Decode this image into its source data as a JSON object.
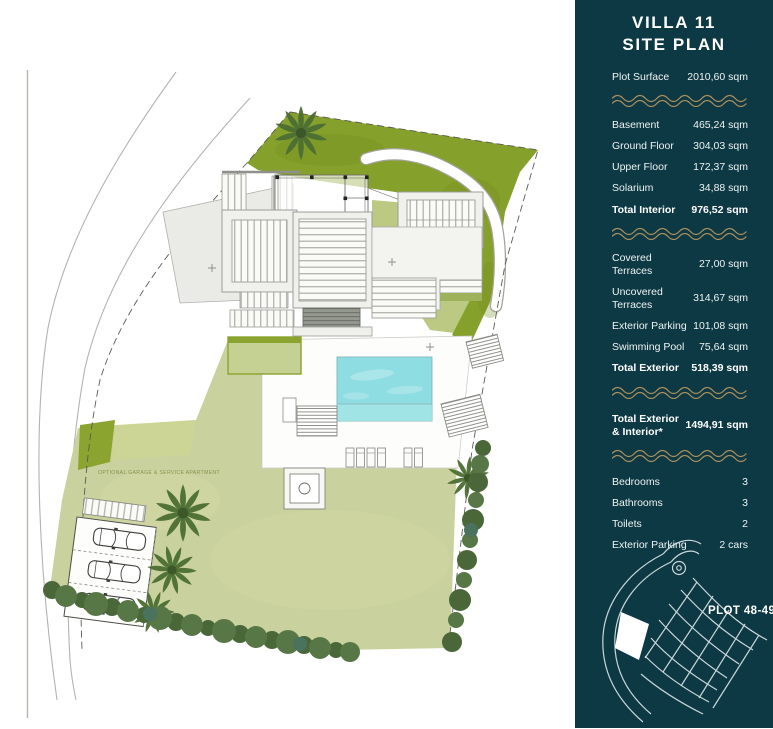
{
  "plan": {
    "note_label": "OPTIONAL GARAGE & SERVICE APARTMENT",
    "colors": {
      "band_green": "#86a02c",
      "light_green": "#bcc983",
      "lawn": "#c9d29e",
      "pool": "#8edde2",
      "concrete": "#f0f0ed",
      "road_line": "#b3b3af"
    }
  },
  "sidebar": {
    "background": "#0d3944",
    "wave_color": "#ab8f5c",
    "title_line1": "VILLA 11",
    "title_line2": "SITE PLAN",
    "plot_surface": {
      "label": "Plot Surface",
      "value": "2010,60 sqm"
    },
    "interior": {
      "rows": [
        {
          "label": "Basement",
          "value": "465,24 sqm"
        },
        {
          "label": "Ground Floor",
          "value": "304,03 sqm"
        },
        {
          "label": "Upper Floor",
          "value": "172,37 sqm"
        },
        {
          "label": "Solarium",
          "value": "34,88 sqm"
        }
      ],
      "total": {
        "label": "Total Interior",
        "value": "976,52 sqm"
      }
    },
    "exterior": {
      "rows": [
        {
          "label": "Covered Terraces",
          "value": "27,00 sqm"
        },
        {
          "label": "Uncovered Terraces",
          "value": "314,67 sqm"
        },
        {
          "label": "Exterior Parking",
          "value": "101,08 sqm"
        },
        {
          "label": "Swimming Pool",
          "value": "75,64 sqm"
        }
      ],
      "total": {
        "label": "Total Exterior",
        "value": "518,39 sqm"
      }
    },
    "grand_total": {
      "label": "Total Exterior & Interior*",
      "value": "1494,91 sqm"
    },
    "features": [
      {
        "label": "Bedrooms",
        "value": "3"
      },
      {
        "label": "Bathrooms",
        "value": "3"
      },
      {
        "label": "Toilets",
        "value": "2"
      },
      {
        "label": "Exterior Parking",
        "value": "2 cars"
      }
    ],
    "plot_label": "PLOT 48-49"
  }
}
